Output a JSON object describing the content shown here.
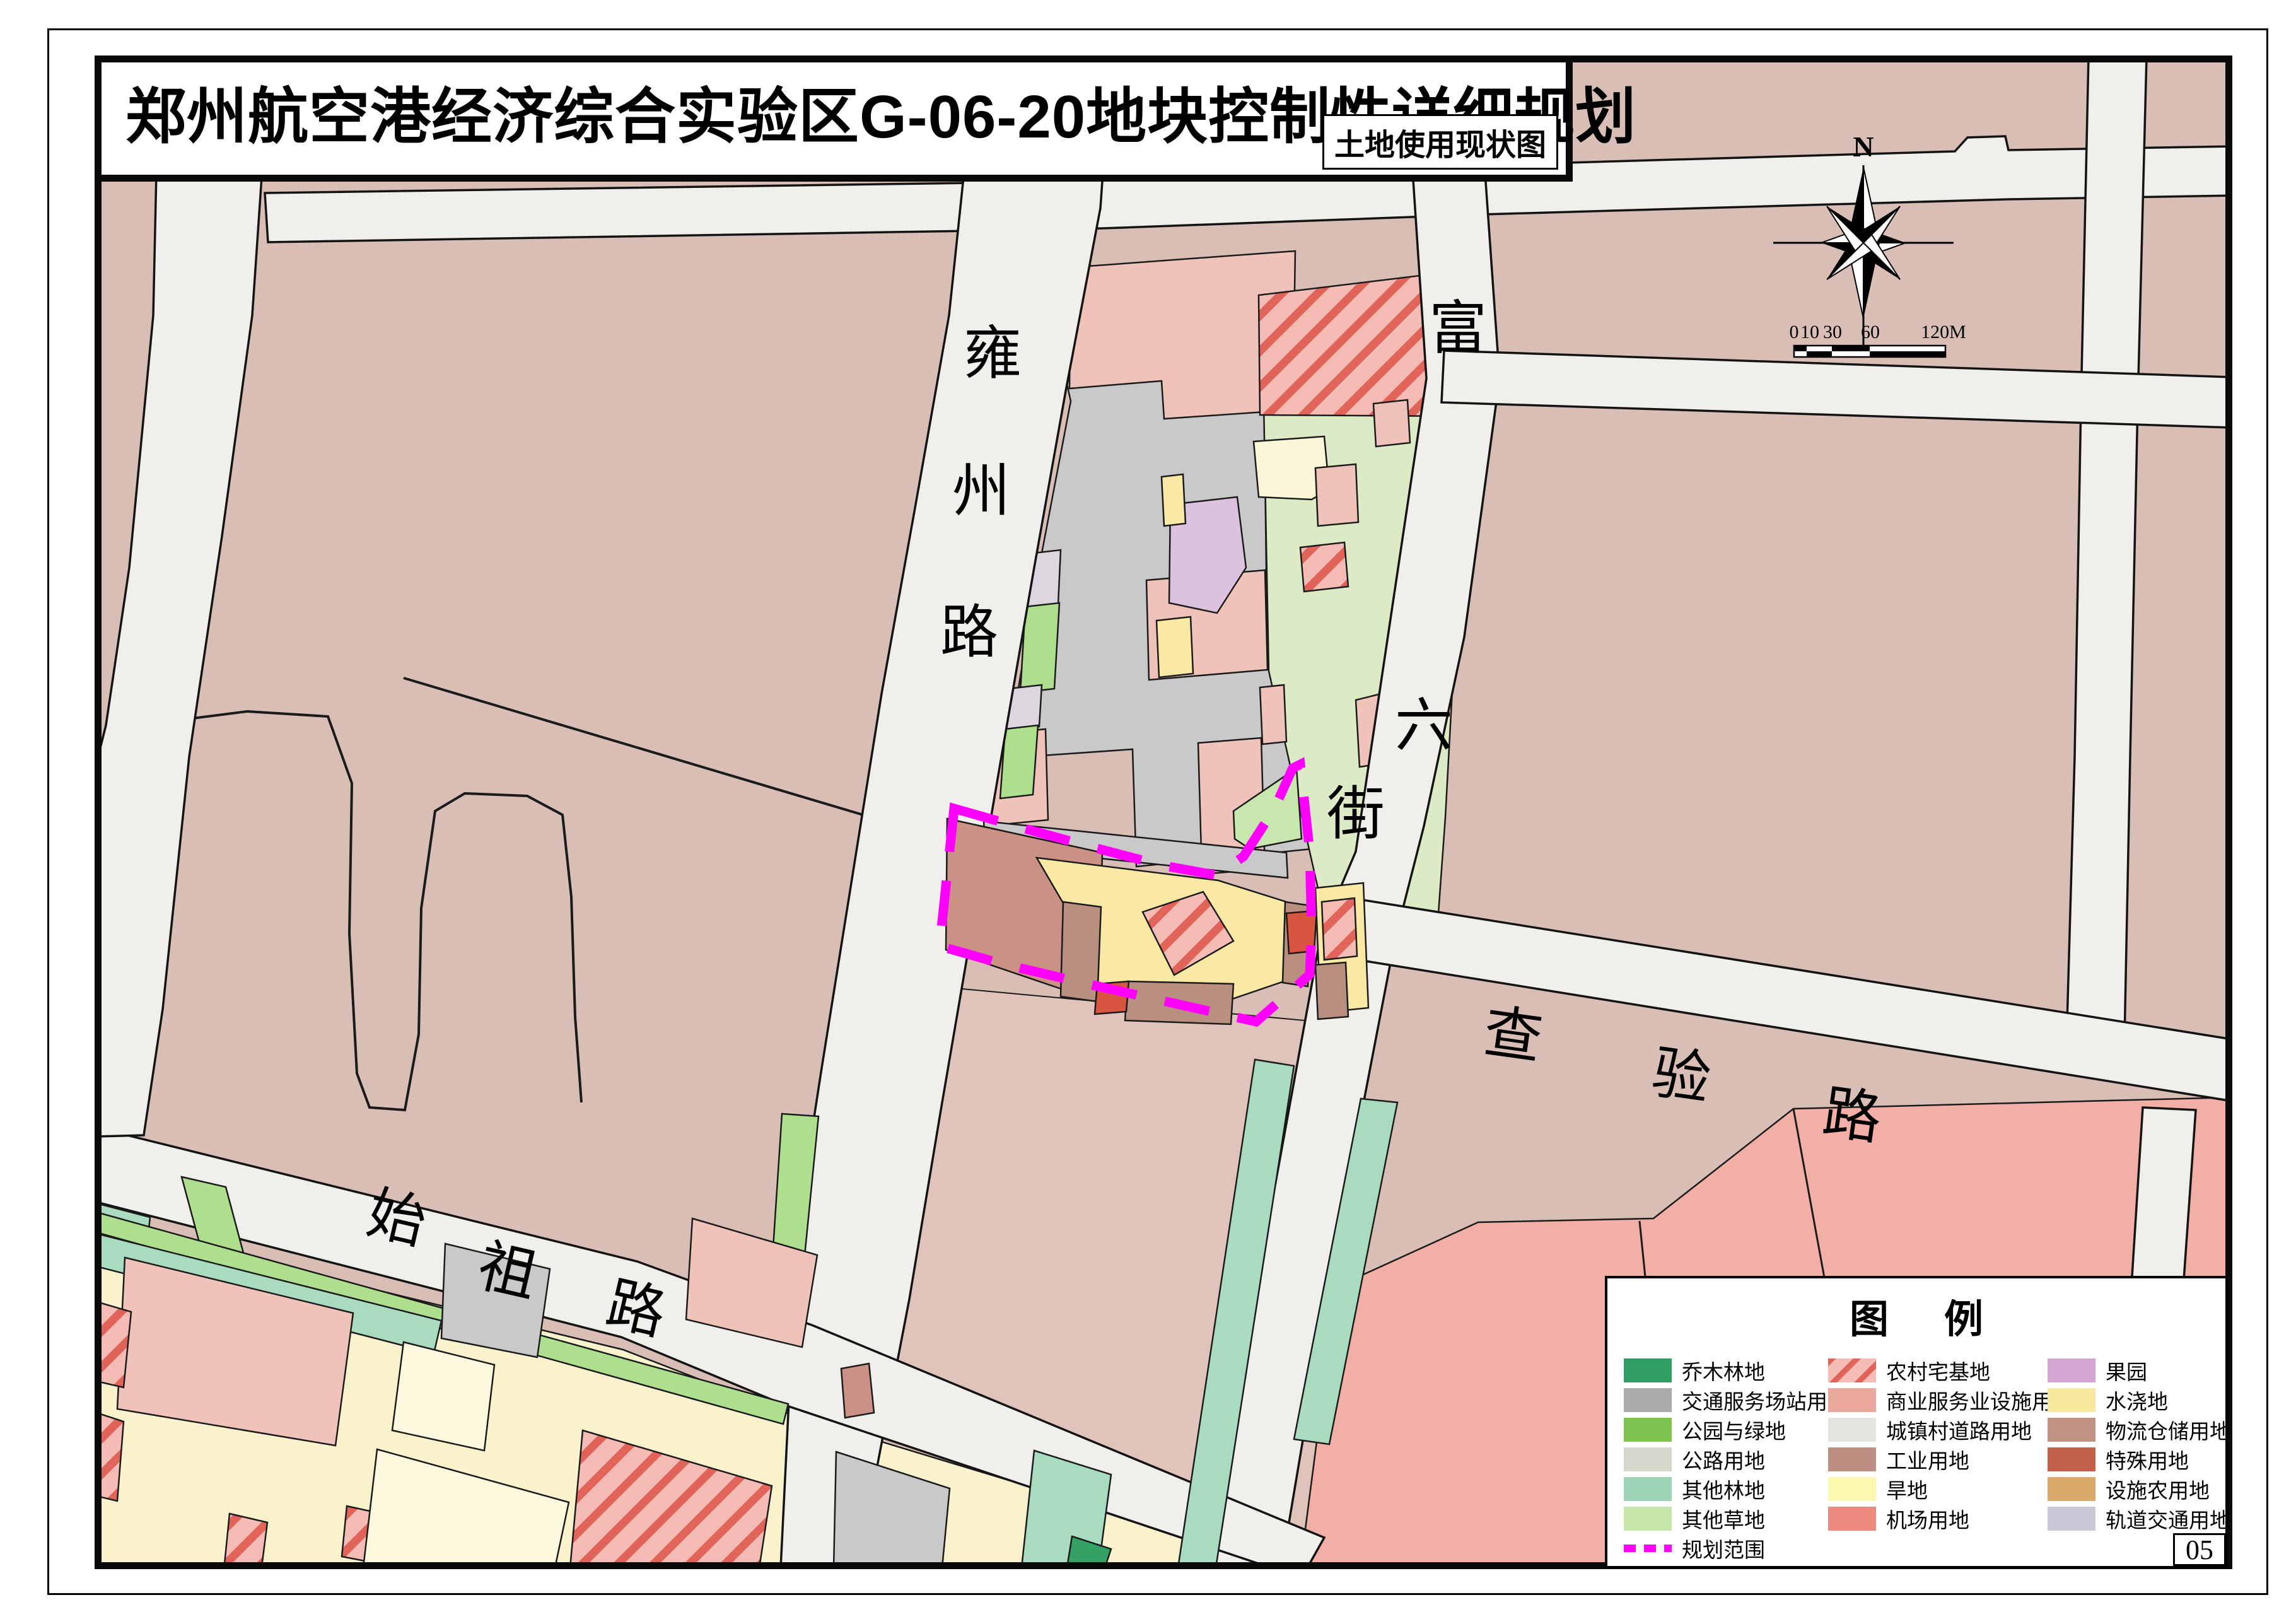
{
  "title": {
    "main": "郑州航空港经济综合实验区G-06-20地块控制性详细规划",
    "subtitle": "土地使用现状图"
  },
  "page_number": "05",
  "compass": {
    "north_label": "N"
  },
  "scalebar": {
    "labels": [
      "0",
      "10",
      "30",
      "60",
      "120M"
    ]
  },
  "roads": {
    "yongzhou": {
      "name": "雍州路"
    },
    "fuliu": {
      "name": "富六街"
    },
    "chayan": {
      "name": "查验路"
    },
    "shizu": {
      "name": "始祖路"
    }
  },
  "legend": {
    "title": "图例",
    "columns": [
      [
        {
          "label": "乔木林地",
          "color": "#2E9E62"
        },
        {
          "label": "交通服务场站用地",
          "color": "#ABABAB"
        },
        {
          "label": "公园与绿地",
          "color": "#7CC34F"
        },
        {
          "label": "公路用地",
          "color": "#D3D8CA"
        },
        {
          "label": "其他林地",
          "color": "#9ED4B5"
        },
        {
          "label": "其他草地",
          "color": "#C7E6AC"
        },
        {
          "label": "规划范围",
          "dash": true
        }
      ],
      [
        {
          "label": "农村宅基地",
          "hatch": true
        },
        {
          "label": "商业服务业设施用地",
          "color": "#EBA99E"
        },
        {
          "label": "城镇村道路用地",
          "color": "#E4E4E0"
        },
        {
          "label": "工业用地",
          "color": "#BE8E82"
        },
        {
          "label": "旱地",
          "color": "#FBF8B0"
        },
        {
          "label": "机场用地",
          "color": "#EC8A7D"
        }
      ],
      [
        {
          "label": "果园",
          "color": "#D3A6D2"
        },
        {
          "label": "水浇地",
          "color": "#F7E8A0"
        },
        {
          "label": "物流仓储用地",
          "color": "#C19384"
        },
        {
          "label": "特殊用地",
          "color": "#C2604A"
        },
        {
          "label": "设施农用地",
          "color": "#D9A96B"
        },
        {
          "label": "轨道交通用地",
          "color": "#CBC7D6"
        }
      ]
    ]
  },
  "colors": {
    "background_parcel": "#D9BEB6",
    "parcel_light": "#E0C4BC",
    "road_fill": "#F0EFEC",
    "depot_gray": "#C9C9C9",
    "commercial_pink": "#EFC3B9",
    "airport_pink": "#F2AFA5",
    "village_green": "#DCEBC5",
    "grass_green": "#C8E7AE",
    "park_green": "#AEDF8E",
    "forest_teal": "#A8DBC0",
    "tree_green": "#36A165",
    "cream": "#F9F2CD",
    "cream_light": "#FCF9DF",
    "paddy_yellow": "#FAE9A5",
    "pale_yellow": "#FBF6D8",
    "orchard_purple": "#DCC2DF",
    "rail_lavender": "#DDD6DF",
    "logistics_brown": "#B98F7F",
    "special_red": "#D8553F",
    "brick": "#CB9184",
    "agri_tan": "#E0BE93",
    "boundary_magenta": "#FF00FF"
  }
}
